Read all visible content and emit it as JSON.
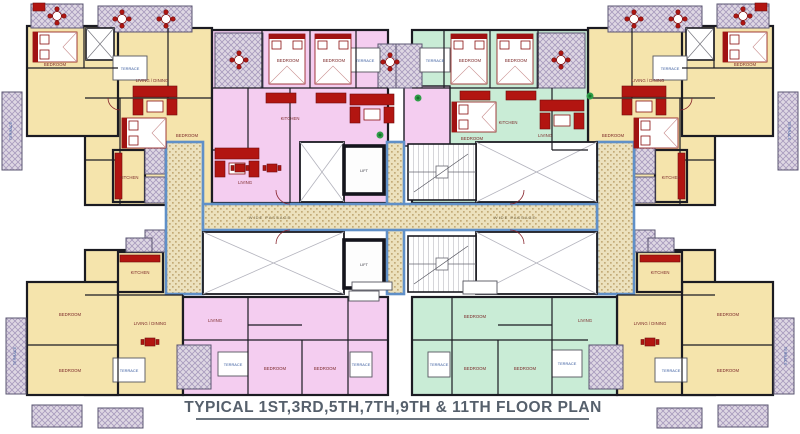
{
  "title": {
    "text": "TYPICAL 1ST,3RD,5TH,7TH,9TH & 11TH FLOOR PLAN"
  },
  "labels": {
    "bedroom": "BEDROOM",
    "living": "LIVING",
    "living_dining": "LIVING / DINING",
    "kitchen": "KITCHEN",
    "terrace": "TERRACE",
    "lift": "LIFT",
    "wide_passage": "WIDE PASSAGE"
  },
  "colors": {
    "wall": "#1b1b22",
    "cream_room": "#f5e4ac",
    "pink_room": "#f4cdf0",
    "green_room": "#c9ecd6",
    "corridor_fill": "#ece1bd",
    "corridor_border": "#6090c8",
    "terrace_hatch": "#ded7e3",
    "furniture_red": "#b21511",
    "terrace_label": "#35589c",
    "room_label": "#7c2a2a",
    "title_text": "#56606c"
  }
}
